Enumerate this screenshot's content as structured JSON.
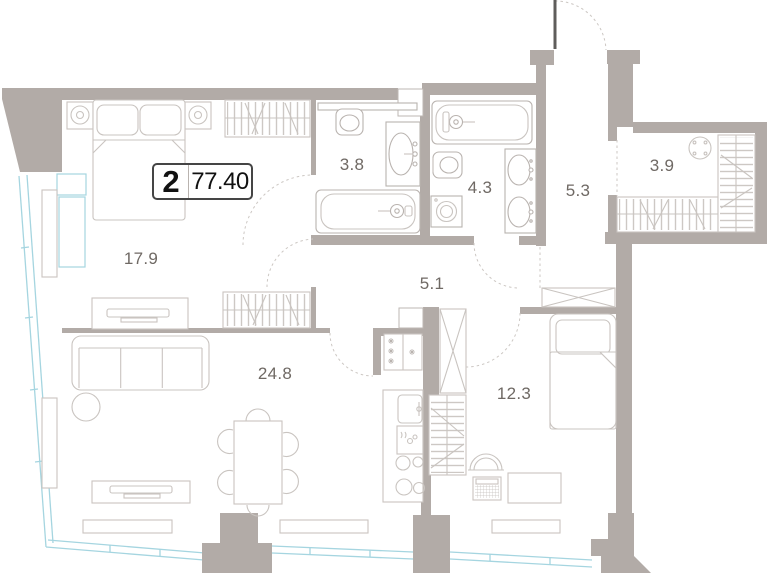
{
  "plan": {
    "unit_badge": {
      "rooms": "2",
      "area": "77.40"
    },
    "rooms": [
      {
        "id": "bedroom",
        "area_label": "17.9",
        "x": 141,
        "y": 259
      },
      {
        "id": "living-kitchen",
        "area_label": "24.8",
        "x": 275,
        "y": 374
      },
      {
        "id": "bathroom",
        "area_label": "3.8",
        "x": 352,
        "y": 165
      },
      {
        "id": "bathroom-2",
        "area_label": "4.3",
        "x": 480,
        "y": 188
      },
      {
        "id": "hallway",
        "area_label": "5.3",
        "x": 578,
        "y": 191
      },
      {
        "id": "wardrobe-room",
        "area_label": "3.9",
        "x": 662,
        "y": 166
      },
      {
        "id": "corridor",
        "area_label": "5.1",
        "x": 432,
        "y": 284
      },
      {
        "id": "bedroom-2",
        "area_label": "12.3",
        "x": 514,
        "y": 394
      }
    ],
    "colors": {
      "wall": "#b2aba7",
      "furniture": "#c9c4c0",
      "fixture": "#b9b3af",
      "glazing": "#a5d5e0",
      "text": "#6f6964",
      "badge_border": "#454545",
      "badge_text": "#111111"
    }
  }
}
